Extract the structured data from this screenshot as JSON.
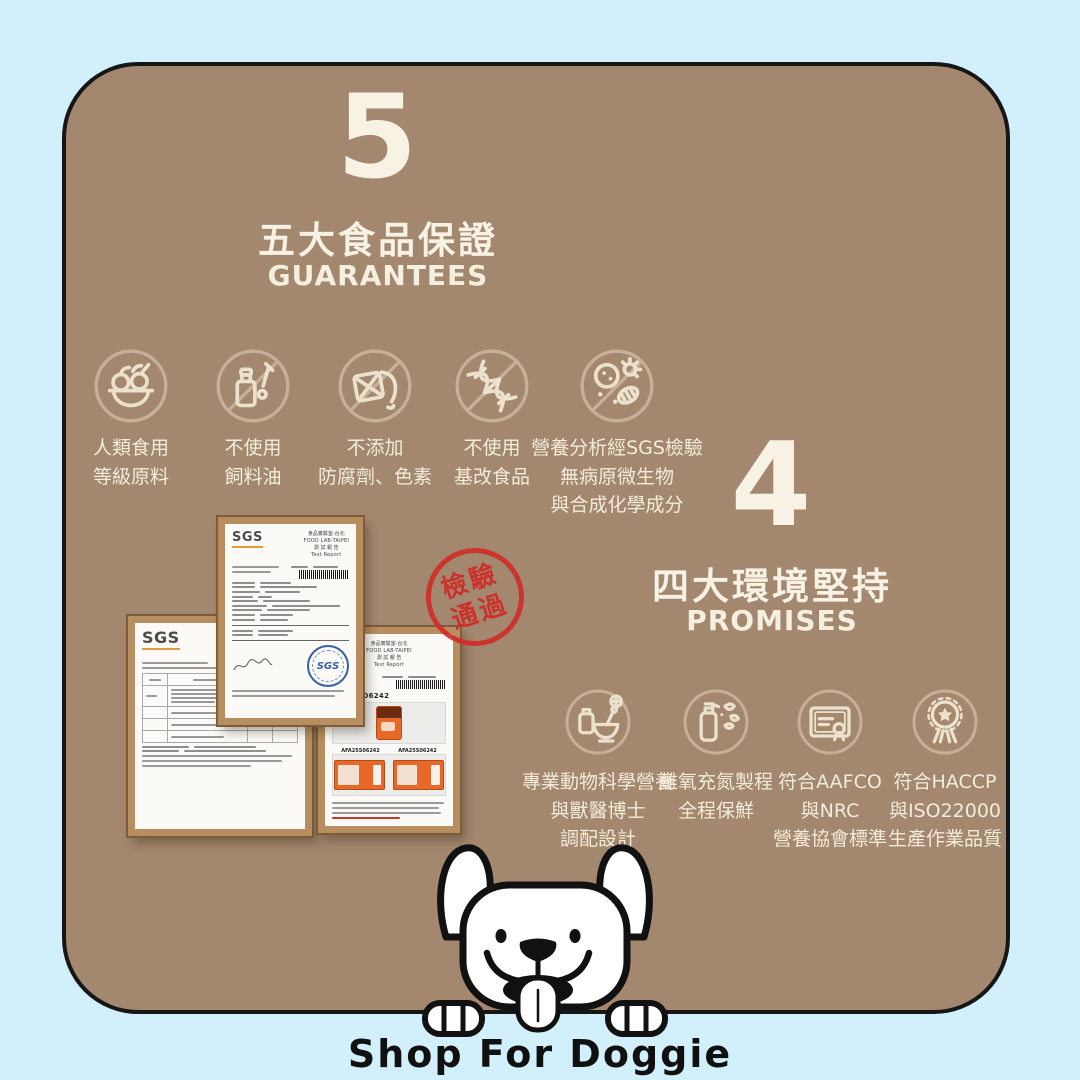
{
  "colors": {
    "background": "#d2f0fc",
    "card": "#a3876e",
    "card_border": "#161616",
    "cream_text": "#f5efe0",
    "icon_ring": "#c7b09a",
    "stamp_red": "#cf2d28",
    "doc_frame": "#b78e60",
    "sgs_stamp_blue": "#3660a8",
    "package_orange": "#e8682a"
  },
  "guarantees": {
    "number": "5",
    "title_zh": "五大食品保證",
    "title_en": "GUARANTEES",
    "items": [
      {
        "icon": "fruit-basket-icon",
        "lines": [
          "人類食用",
          "等級原料"
        ]
      },
      {
        "icon": "dropper-bottle-icon",
        "lines": [
          "不使用",
          "飼料油"
        ]
      },
      {
        "icon": "oil-jug-icon",
        "lines": [
          "不添加",
          "防腐劑、色素"
        ]
      },
      {
        "icon": "dna-icon",
        "lines": [
          "不使用",
          "基改食品"
        ]
      },
      {
        "icon": "microbes-icon",
        "lines": [
          "營養分析經SGS檢驗",
          "無病原微生物",
          "與合成化學成分"
        ]
      }
    ]
  },
  "promises": {
    "number": "4",
    "title_zh": "四大環境堅持",
    "title_en": "PROMISES",
    "items": [
      {
        "icon": "mortar-pestle-icon",
        "lines": [
          "專業動物科學營養",
          "與獸醫博士",
          "調配設計"
        ]
      },
      {
        "icon": "spray-leaves-icon",
        "lines": [
          "離氧充氮製程",
          "全程保鮮"
        ]
      },
      {
        "icon": "certificate-icon",
        "lines": [
          "符合AAFCO",
          "與NRC",
          "營養協會標準"
        ]
      },
      {
        "icon": "medal-icon",
        "lines": [
          "符合HACCP",
          "與ISO22000",
          "生產作業品質"
        ]
      }
    ]
  },
  "inspection_stamp": {
    "line1": "檢驗",
    "line2": "通過"
  },
  "documents": {
    "logo": "SGS",
    "lab_zh": "食品實驗室-台北",
    "lab_en": "FOOD LAB-TAIPEI",
    "report_zh": "測 試 報 告",
    "report_en": "Test Report",
    "sample_id": "AFA25S06242"
  },
  "footer": {
    "brand": "Shop For Doggie"
  }
}
